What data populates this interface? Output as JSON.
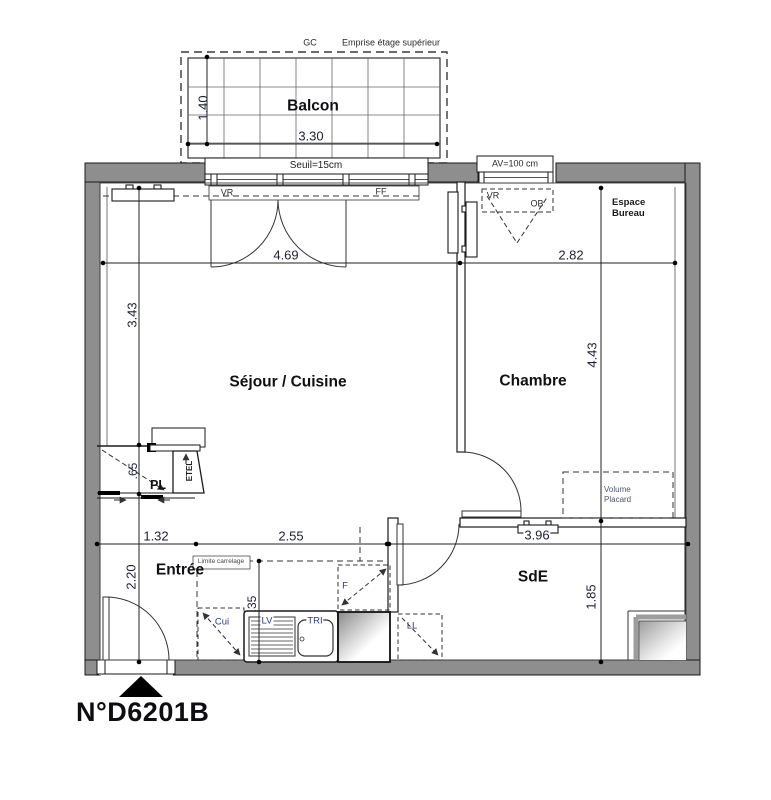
{
  "plan": {
    "number": "N°D6201B"
  },
  "upper_floor": {
    "gc": "GC",
    "label": "Emprise étage supérieur"
  },
  "balcony": {
    "name": "Balcon",
    "depth": "1.40",
    "width": "3.30",
    "threshold": "Seuil=15cm"
  },
  "openings": {
    "bay_shutter": "VR",
    "bay_fixed": "FF",
    "chambre_window_label": "AV=100 cm",
    "chambre_shutter": "VR",
    "chambre_tilt": "OB"
  },
  "sejour": {
    "name": "Séjour / Cuisine",
    "width": "4.69",
    "depth": "3.43"
  },
  "chambre": {
    "name": "Chambre",
    "width": "2.82",
    "depth": "4.43",
    "office_line1": "Espace",
    "office_line2": "Bureau",
    "closet_line1": "Volume",
    "closet_line2": "Placard"
  },
  "entree": {
    "name": "Entrée",
    "width": "1.32",
    "depth": "2.20"
  },
  "storage": {
    "closet": "PL",
    "closet_depth": ".65",
    "duct": "ETEL"
  },
  "kitchen": {
    "width": "2.55",
    "counter": ".35",
    "tile_limit": "Limite carrelage",
    "stove": "Cui",
    "dishwasher": "LV",
    "sorting": "TRI",
    "fridge": "F",
    "washer": "LL"
  },
  "sde": {
    "name": "SdE",
    "width": "3.96",
    "depth": "1.85"
  },
  "colors": {
    "wall": "#8e8e8e",
    "line": "#1a1a1a",
    "dim_text": "#1c2033",
    "appliance_text": "#2e3a8c"
  }
}
